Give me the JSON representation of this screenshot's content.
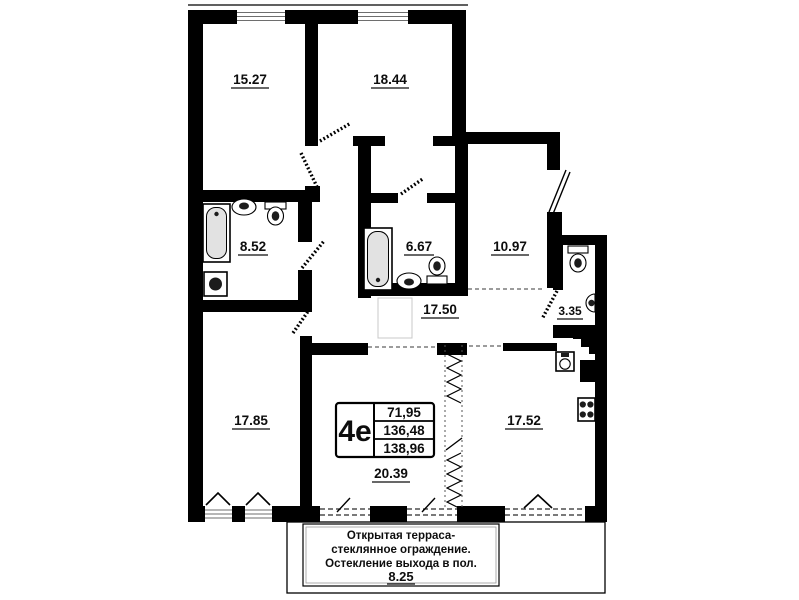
{
  "floor_plan": {
    "title": "Apartment floor plan",
    "unit_type": "4е",
    "areas_table": {
      "living_area": "71,95",
      "area_without_balcony": "136,48",
      "total_area": "138,96"
    },
    "rooms": {
      "room_top_left": {
        "area": "15.27"
      },
      "room_top_right": {
        "area": "18.44"
      },
      "bathroom_left": {
        "area": "8.52"
      },
      "bathroom_center": {
        "area": "6.67"
      },
      "room_right": {
        "area": "10.97"
      },
      "wc": {
        "area": "3.35"
      },
      "corridor": {
        "area": "17.50"
      },
      "room_bottom_left": {
        "area": "17.85"
      },
      "kitchen": {
        "area": "17.52"
      },
      "living_room": {
        "area": "20.39"
      }
    },
    "terrace": {
      "note_line1": "Открытая терраса-",
      "note_line2": "стеклянное ограждение.",
      "note_line3": "Остекление выхода в пол.",
      "area": "8.25"
    },
    "colors": {
      "walls": "#000000",
      "background": "#ffffff",
      "fixture_fill": "#e2e2e2"
    }
  }
}
